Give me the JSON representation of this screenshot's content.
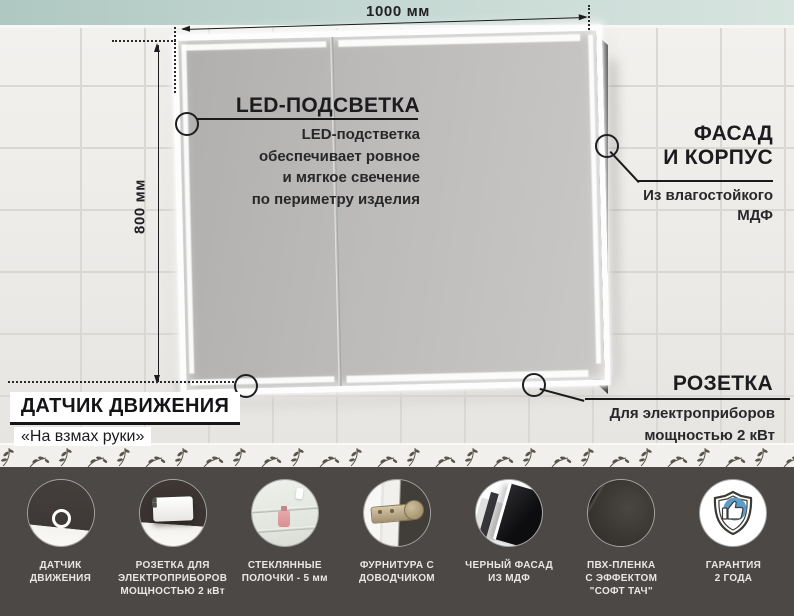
{
  "dimensions": {
    "width": "1000 мм",
    "height": "800 мм"
  },
  "callouts": {
    "led": {
      "title": "LED-ПОДСВЕТКА",
      "desc_lines": [
        "LED-подстветка",
        "обеспечивает ровное",
        "и мягкое свечение",
        "по периметру изделия"
      ]
    },
    "facade": {
      "title_lines": [
        "ФАСАД",
        "И КОРПУС"
      ],
      "desc_lines": [
        "Из влагостойкого",
        "МДФ"
      ]
    },
    "socket": {
      "title": "РОЗЕТКА",
      "desc_lines": [
        "Для электроприборов",
        "мощностью 2 кВт"
      ]
    },
    "sensor": {
      "title": "ДАТЧИК ДВИЖЕНИЯ",
      "subtitle": "«На взмах руки»"
    }
  },
  "features": [
    {
      "icon": "motion-sensor-icon",
      "label_lines": [
        "ДАТЧИК",
        "ДВИЖЕНИЯ"
      ]
    },
    {
      "icon": "power-socket-icon",
      "label_lines": [
        "РОЗЕТКА ДЛЯ",
        "ЭЛЕКТРОПРИБОРОВ",
        "МОЩНОСТЬЮ 2 кВт"
      ]
    },
    {
      "icon": "glass-shelf-icon",
      "label_lines": [
        "СТЕКЛЯННЫЕ",
        "ПОЛОЧКИ - 5 мм"
      ]
    },
    {
      "icon": "soft-close-hinge-icon",
      "label_lines": [
        "ФУРНИТУРА С",
        "ДОВОДЧИКОМ"
      ]
    },
    {
      "icon": "black-facade-icon",
      "label_lines": [
        "ЧЕРНЫЙ ФАСАД",
        "ИЗ МДФ"
      ]
    },
    {
      "icon": "pvc-film-icon",
      "label_lines": [
        "ПВХ-ПЛЕНКА",
        "С ЭФФЕКТОМ",
        "\"СОФТ ТАЧ\""
      ]
    },
    {
      "icon": "warranty-icon",
      "label_lines": [
        "ГАРАНТИЯ",
        "2 ГОДА"
      ]
    }
  ],
  "colors": {
    "footer_background": "#4b4846",
    "annotation_ink": "#1c1c1e",
    "warranty_blue": "#5b9dc9",
    "glass_strip": "#c6d8d3"
  }
}
